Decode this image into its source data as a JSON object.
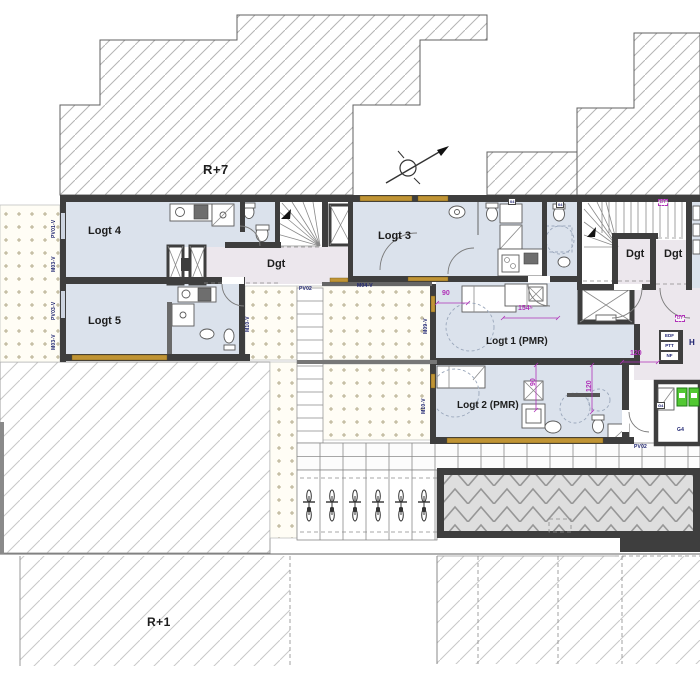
{
  "plan": {
    "levels": {
      "upper": "R+7",
      "lower": "R+1"
    },
    "rooms": {
      "logt1": "Logt 1 (PMR)",
      "logt2": "Logt 2 (PMR)",
      "logt3": "Logt 3",
      "logt4": "Logt 4",
      "logt5": "Logt 5",
      "corridor": "Dgt"
    },
    "wall_codes": {
      "pv01v": "PV01-V",
      "m03v": "M03-V",
      "pv03v": "PV03-V",
      "m04v": "M04-V",
      "m09v": "M09-V",
      "m10v": "M10-V",
      "pv02": "PV02",
      "door04": "04"
    },
    "dimensions": {
      "d90": "90",
      "d120": "120",
      "d154": "154⁵"
    },
    "tags": {
      "door": "DT",
      "hall": "H",
      "bin": "G4"
    },
    "utility_boxes": {
      "b1": "EDF",
      "b2": "PTT",
      "b3": "NF"
    },
    "colors": {
      "wall": "#3e3e3e",
      "room": "#dbe2ec",
      "corridor": "#ece7ed",
      "window": "#c09435",
      "dimension": "#b032b8",
      "code": "#1c2270",
      "bin": "#52c832"
    }
  }
}
